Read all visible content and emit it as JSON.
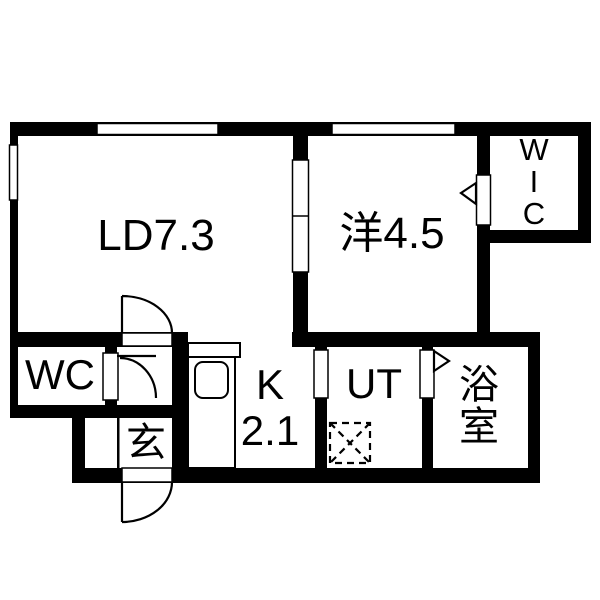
{
  "floor_plan": {
    "background_color": "#ffffff",
    "wall_color": "#000000",
    "rooms": {
      "living_dining": {
        "label": "LD7.3"
      },
      "western_room": {
        "label": "洋4.5"
      },
      "walk_in_closet": {
        "label_chars": [
          "W",
          "I",
          "C"
        ]
      },
      "toilet": {
        "label": "WC"
      },
      "entrance": {
        "label": "玄"
      },
      "kitchen": {
        "label": "K",
        "size": "2.1"
      },
      "utility": {
        "label": "UT"
      },
      "bathroom": {
        "label_chars": [
          "浴",
          "室"
        ]
      }
    }
  }
}
